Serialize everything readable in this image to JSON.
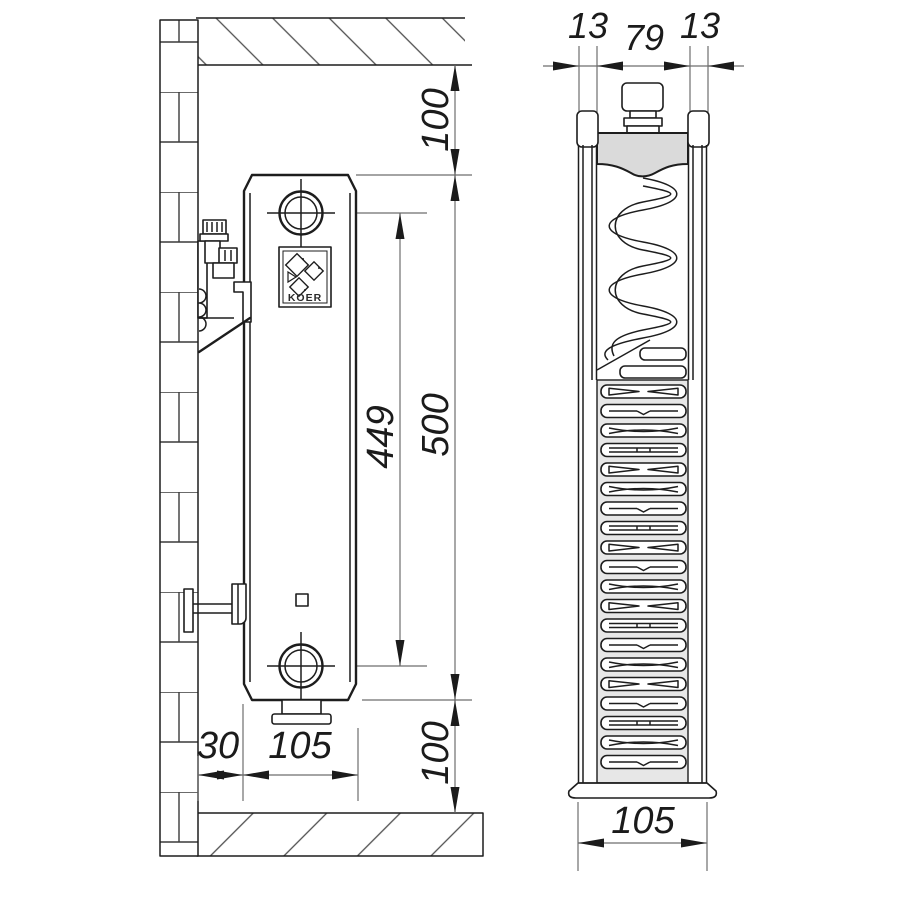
{
  "logo": {
    "text": "KOER"
  },
  "dimensions": {
    "side_view": {
      "ceiling_offset": "100",
      "height": "500",
      "port_spacing": "449",
      "floor_offset": "100",
      "wall_gap": "30",
      "depth": "105"
    },
    "section_view": {
      "panel_left": "13",
      "core_width": "79",
      "panel_right": "13",
      "depth": "105"
    }
  },
  "colors": {
    "line": "#1d1d1d",
    "thin_line": "#6e6e6e",
    "header_fill": "#dadada",
    "grille_fill": "#e7e7e7",
    "background": "#ffffff"
  }
}
